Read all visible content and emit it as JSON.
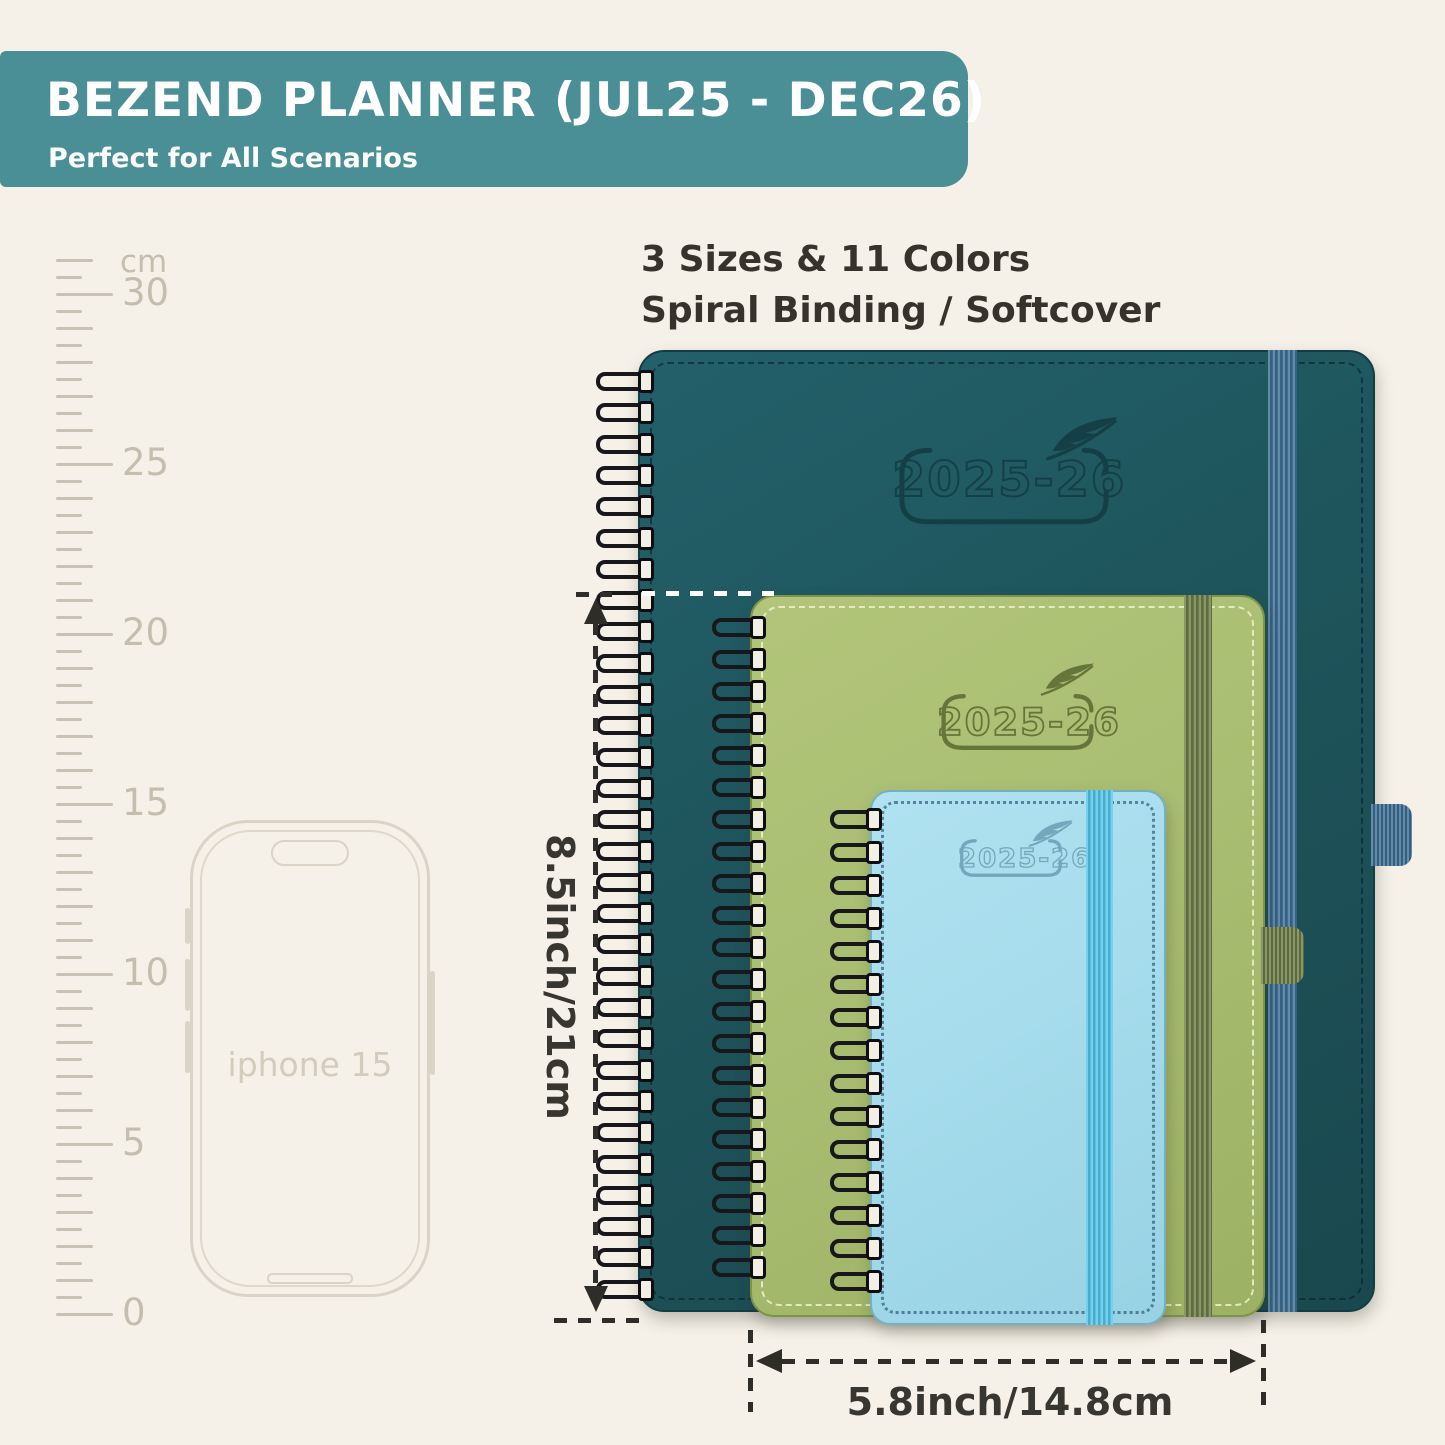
{
  "banner": {
    "title": "BEZEND PLANNER (JUL25 - DEC26)",
    "subtitle": "Perfect for All Scenarios",
    "bg_color": "#4a8e96",
    "text_color": "#ffffff"
  },
  "info": {
    "line1": "3 Sizes & 11 Colors",
    "line2": "Spiral Binding / Softcover"
  },
  "ruler": {
    "unit": "cm",
    "labels": [
      "0",
      "5",
      "10",
      "15",
      "20",
      "25",
      "30"
    ]
  },
  "phone": {
    "label": "iphone 15"
  },
  "planners": [
    {
      "id": "large",
      "year_label": "2025-26",
      "cover_color": "#1e545b",
      "elastic_color": "#3d6e93",
      "emboss_color": "#153f46"
    },
    {
      "id": "medium",
      "year_label": "2025-26",
      "cover_color": "#a9be72",
      "elastic_color": "#6b7c45",
      "emboss_color": "#67753a"
    },
    {
      "id": "small",
      "year_label": "2025-26",
      "cover_color": "#a6dcec",
      "elastic_color": "#54c3e7",
      "emboss_color": "#74a7bc"
    }
  ],
  "dimensions": {
    "height_label": "8.5inch/21cm",
    "width_label": "5.8inch/14.8cm"
  }
}
